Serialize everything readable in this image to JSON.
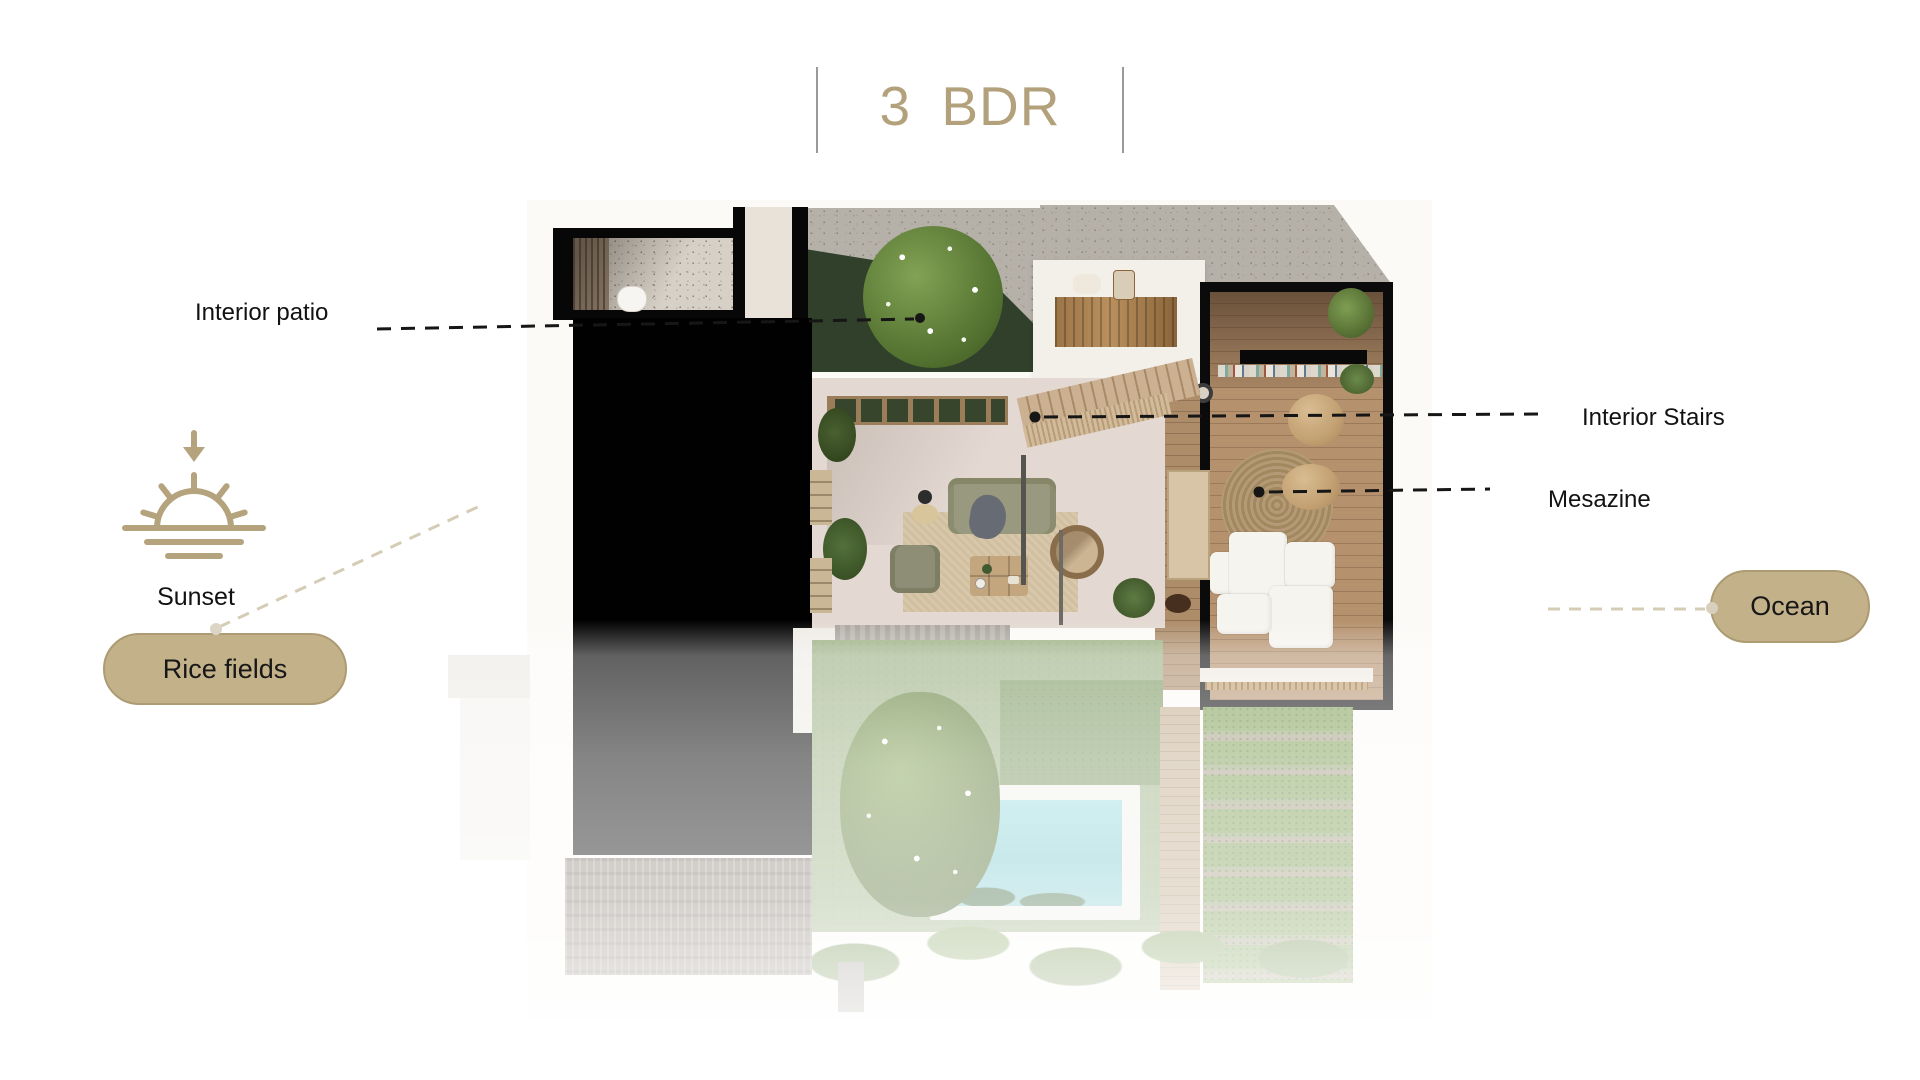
{
  "slide": {
    "title": "3 BDR"
  },
  "callouts": {
    "interior_patio": "Interior patio",
    "interior_stairs": "Interior Stairs",
    "mesazine": "Mesazine",
    "sunset": "Sunset",
    "rice_fields": "Rice fields",
    "ocean": "Ocean"
  },
  "icons": {
    "sunset": "sunset-icon",
    "arrow_down": "arrow-down-icon"
  },
  "colors": {
    "accent_tan": "#b3a17c",
    "pill_fill": "#c3b189",
    "pill_border": "#ac9b73",
    "leader_dark": "#161616",
    "leader_light": "#d5ccb6",
    "pool_water": "#8fd2d6",
    "title_divider": "#9a9a9a",
    "roof_mass": "#010101"
  }
}
